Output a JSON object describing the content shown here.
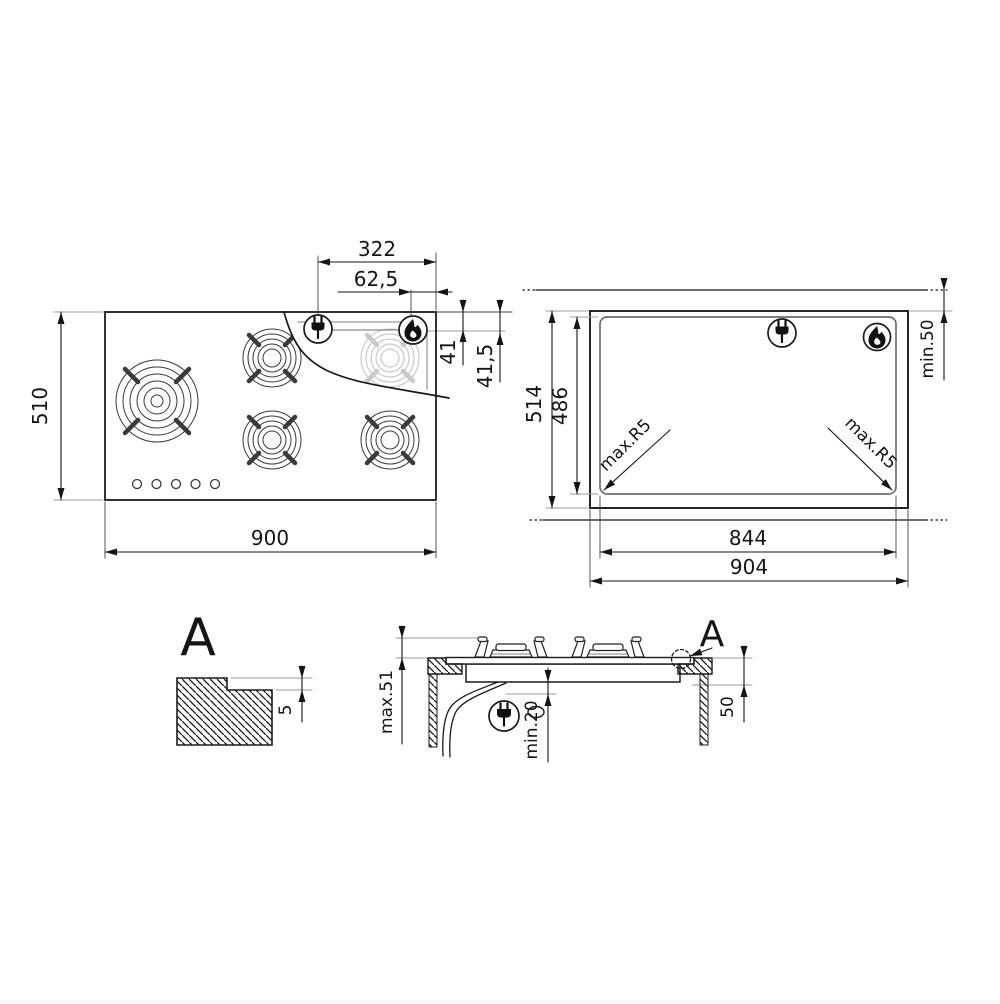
{
  "colors": {
    "line": "#1b1b1b",
    "gray": "#9b9b9b",
    "ghost": "#c9c9c9"
  },
  "hob_top_view": {
    "width": "900",
    "height": "510",
    "plug_from_right": "322",
    "flame_from_right": "62,5",
    "dim_41": "41",
    "dim_41_5": "41,5"
  },
  "cutout_view": {
    "outer_width": "904",
    "cutout_width": "844",
    "outer_height": "514",
    "cutout_height": "486",
    "rear_clearance": "min.50",
    "corner_radius_left": "max.R5",
    "corner_radius_right": "max.R5"
  },
  "detail_view": {
    "label": "A",
    "rebate_depth": "5"
  },
  "section_view": {
    "detail_label": "A",
    "height_max": "max.51",
    "clearance_min": "min.20",
    "side_clearance": "50"
  }
}
